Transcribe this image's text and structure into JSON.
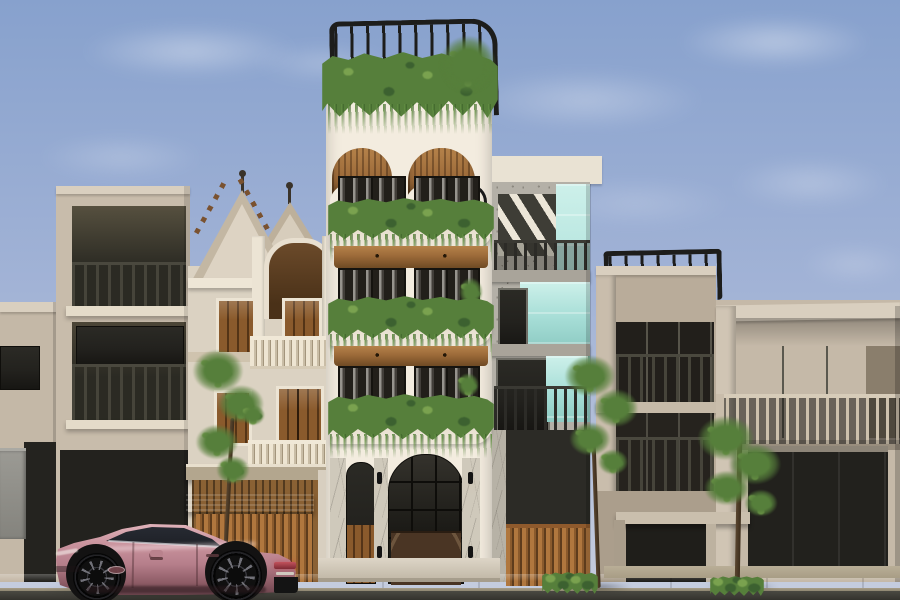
{
  "meta": {
    "title": "Street elevation — architectural render",
    "description": "Photorealistic exterior render of a row of townhouses with a rose-pink fastback sedan parked on the street",
    "canvas": {
      "width": 900,
      "height": 600
    }
  },
  "palette": {
    "sky-top": "#87a1cd",
    "sky-mid": "#a2b3d6",
    "sky-low": "#c6cdde",
    "cloud": "#ffffff",
    "beige": "#c8bcab",
    "beige-dark": "#b2a593",
    "beige-shadow": "#9d9180",
    "fascia": "#d9cfbf",
    "dark-glass": "#23221e",
    "glass-deep": "#171613",
    "rail-dark": "#34332d",
    "cream": "#f3ecdf",
    "cream-shade": "#e3dac9",
    "wood": "#9c6a39",
    "wood-dark": "#6f4a24",
    "wood-light": "#b5824a",
    "plant": "#567f3b",
    "plant-dark": "#3c6130",
    "plant-light": "#7aa24f",
    "railing-black": "#1d1d1b",
    "teal": "#a7ded7",
    "teal-light": "#cdf0ea",
    "terrazzo": "#b4b0a7",
    "terrazzo-dark": "#8c887f",
    "classical": "#dbd2c2",
    "classical-trim": "#ece4d4",
    "classical-shadow": "#b5a88f",
    "door-brown": "#8a5a2c",
    "slat-wood": "#a9793f",
    "marble": "#cfc9bb",
    "sidewalk": "#cfc6b0",
    "sidewalk-dark": "#b6ac95",
    "curb": "#968d76",
    "road": "#45443e",
    "road-dark": "#34332e",
    "car-pink": "#c9939d",
    "car-pink-light": "#e5b9c0",
    "car-pink-dark": "#8e5c66",
    "car-underside": "#5c3a42",
    "tire": "#101010",
    "rim": "#3c3c3c",
    "tail-red": "#8e3038"
  },
  "scene": {
    "sky": {
      "label": "Blue sky with wispy white clouds"
    },
    "buildings": [
      {
        "id": "left-low",
        "label": "Far-left low beige townhouse with dark shopfront"
      },
      {
        "id": "left-tall",
        "label": "Left tall beige townhouse with two recessed balconies"
      },
      {
        "id": "classical",
        "label": "Cream classical villa with twin gables, spires, arched portico, wooden shutters and slatted timber gate"
      },
      {
        "id": "white-tower",
        "label": "White five-storey tower with rooftop rail, planted balconies, timber arch soffits and marble entry"
      },
      {
        "id": "teal-house",
        "label": "Terrazzo house with mint-glass panels, diagonal brise-soleil and timber slat gate"
      },
      {
        "id": "mid-tower",
        "label": "Beige mid-rise with rooftop railing and dark louvred bays"
      },
      {
        "id": "right-house",
        "label": "Wide beige modern house with long slatted balcony, dark garage and carport"
      }
    ],
    "street": {
      "label": "Stone sidewalk, curb and asphalt road"
    },
    "vehicle": {
      "label": "Rose-pink electric fastback sedan parked facing left-to-right"
    },
    "greenery": {
      "label": "Young street trees, balcony vines and low hedges"
    }
  }
}
